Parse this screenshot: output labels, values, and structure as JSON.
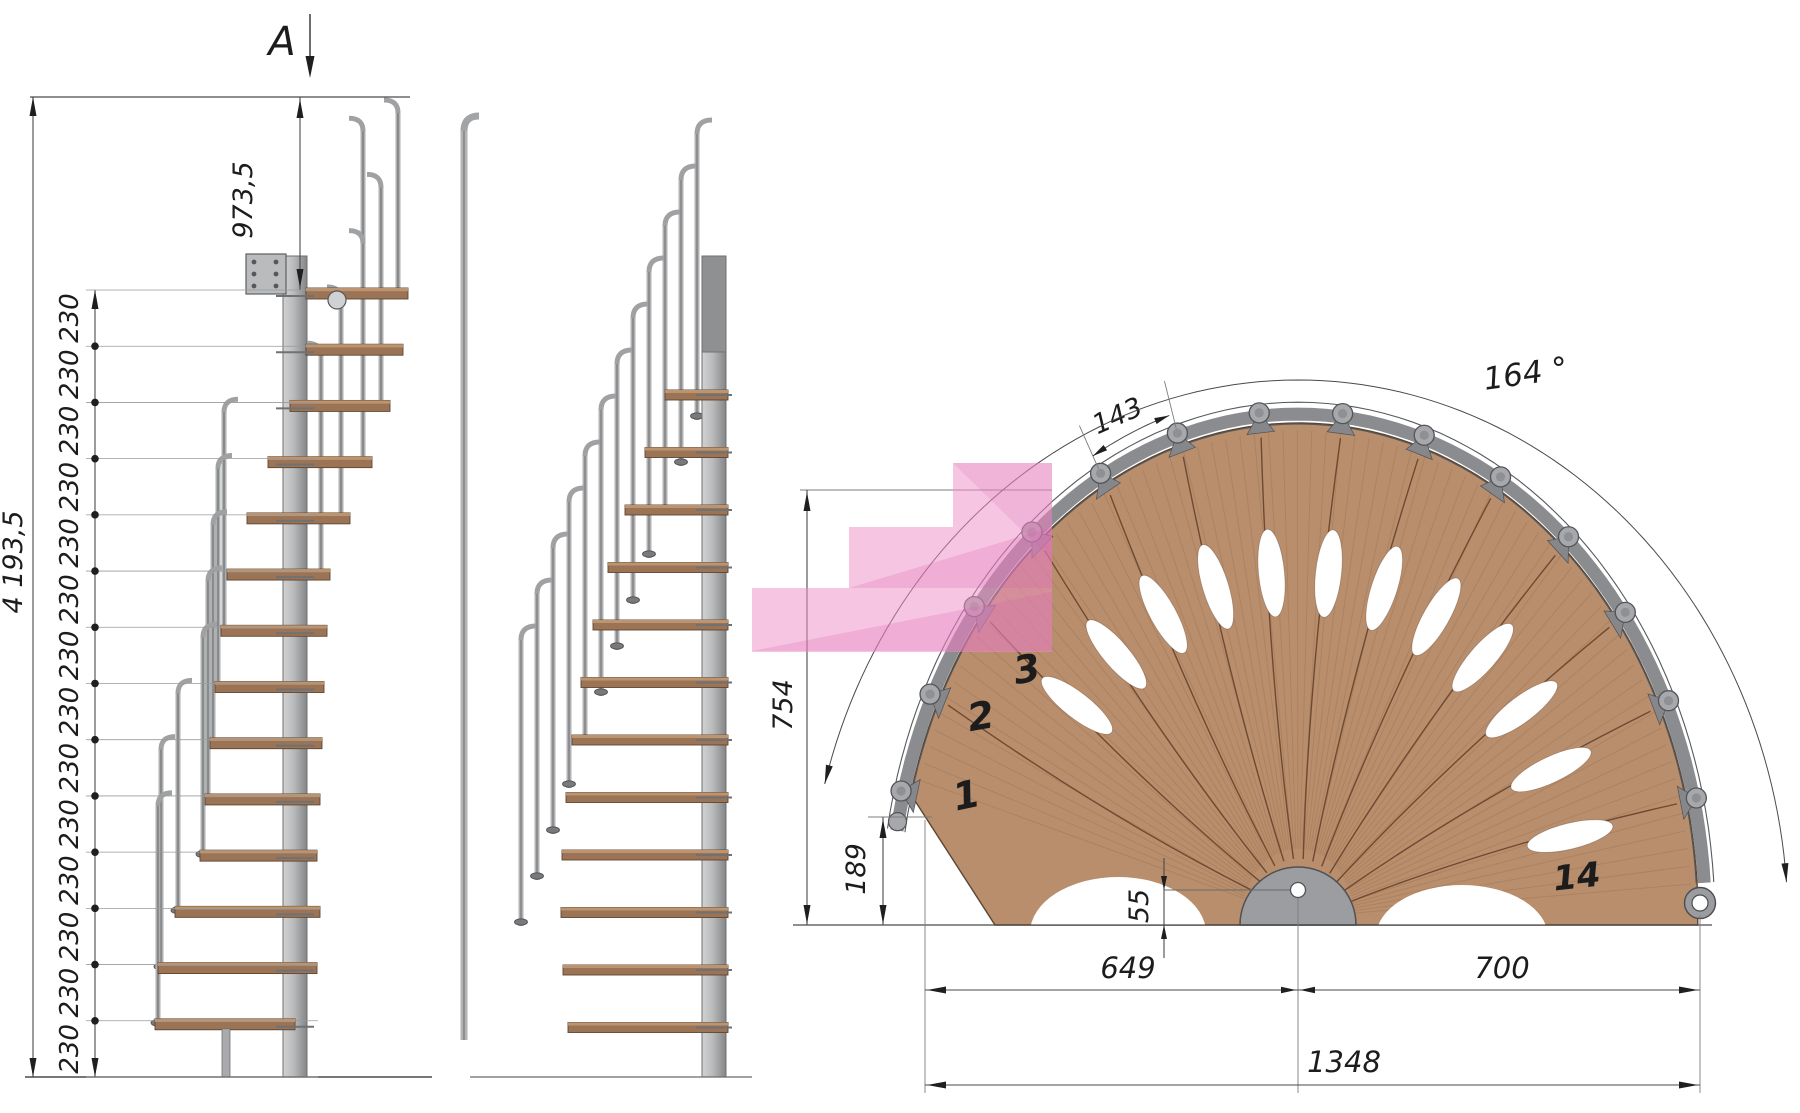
{
  "section_marker": {
    "label": "A"
  },
  "side_elevation": {
    "total_height": "4 193,5",
    "top_flight_height": "973,5",
    "rise_labels": [
      "230",
      "230",
      "230",
      "230",
      "230",
      "230",
      "230",
      "230",
      "230",
      "230",
      "230",
      "230",
      "230",
      "230"
    ]
  },
  "plan": {
    "angle": "164 °",
    "tread_arc": "143",
    "depth": "754",
    "first_step_offset": "189",
    "center_hole_offset": "55",
    "left_run": "649",
    "right_run": "700",
    "overall_width": "1348",
    "step_numbers": [
      "1",
      "2",
      "3",
      "14"
    ]
  },
  "colors": {
    "wood": "#b98e6c",
    "wood_line": "#6d4a33",
    "steel_light": "#c9c9c9",
    "steel": "#a6a8aa",
    "steel_dark": "#5f6163",
    "rim": "#8a8c8f",
    "highlight_pink": "#ee8fc7",
    "highlight_deep": "#d95fae",
    "line": "#4a4a4a"
  }
}
